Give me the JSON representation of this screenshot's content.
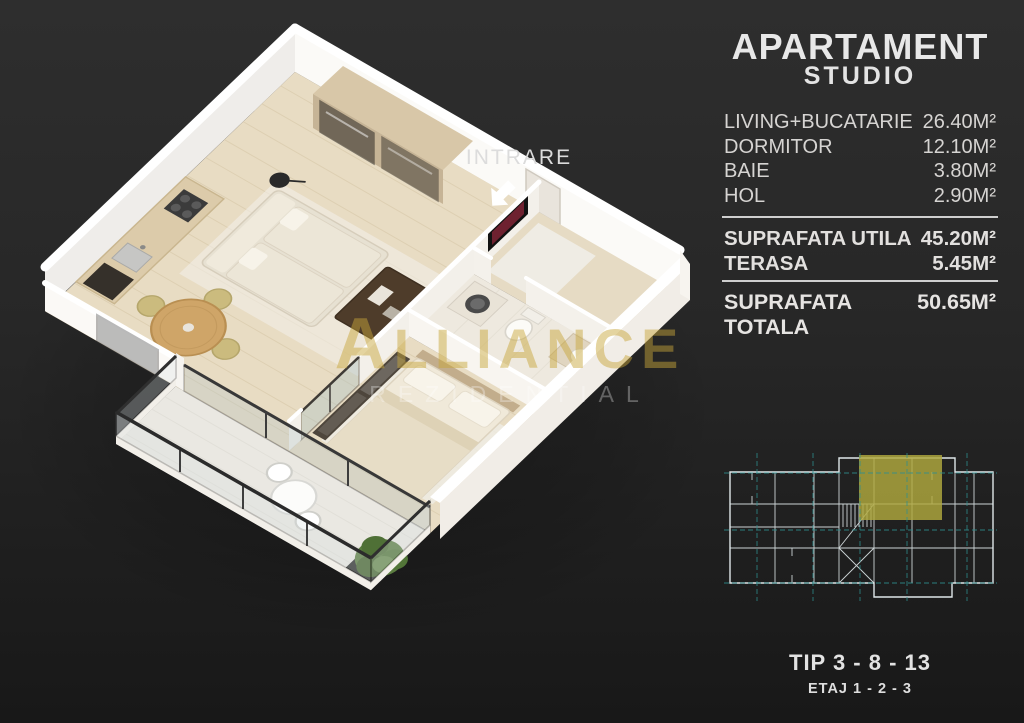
{
  "panel": {
    "title": "APARTAMENT",
    "subtitle": "STUDIO",
    "rooms": [
      {
        "label": "LIVING+BUCATARIE",
        "value": "26.40M²"
      },
      {
        "label": "DORMITOR",
        "value": "12.10M²"
      },
      {
        "label": "BAIE",
        "value": "3.80M²"
      },
      {
        "label": "HOL",
        "value": "2.90M²"
      }
    ],
    "summary": [
      {
        "label": "SUPRAFATA UTILA",
        "value": "45.20M²"
      },
      {
        "label": "TERASA",
        "value": "5.45M²"
      }
    ],
    "total": {
      "label": "SUPRAFATA TOTALA",
      "value": "50.65M²"
    },
    "type_label": "TIP 3 - 8 - 13",
    "floor_label": "ETAJ 1 - 2 - 3"
  },
  "plan": {
    "entrance_label": "INTRARE",
    "watermark": {
      "brand_initial": "A",
      "brand_rest": "LLIANCE",
      "subtitle": "REZIDENTIAL"
    }
  },
  "colors": {
    "bg_top": "#2e2e2e",
    "bg_bottom": "#181818",
    "panel_text": "#d9d9d9",
    "highlight": "#b1aa3e",
    "blueprint_line": "#dfe7e9",
    "blueprint_grid": "#2e8f8f",
    "watermark_gold": "#c8a63a"
  }
}
